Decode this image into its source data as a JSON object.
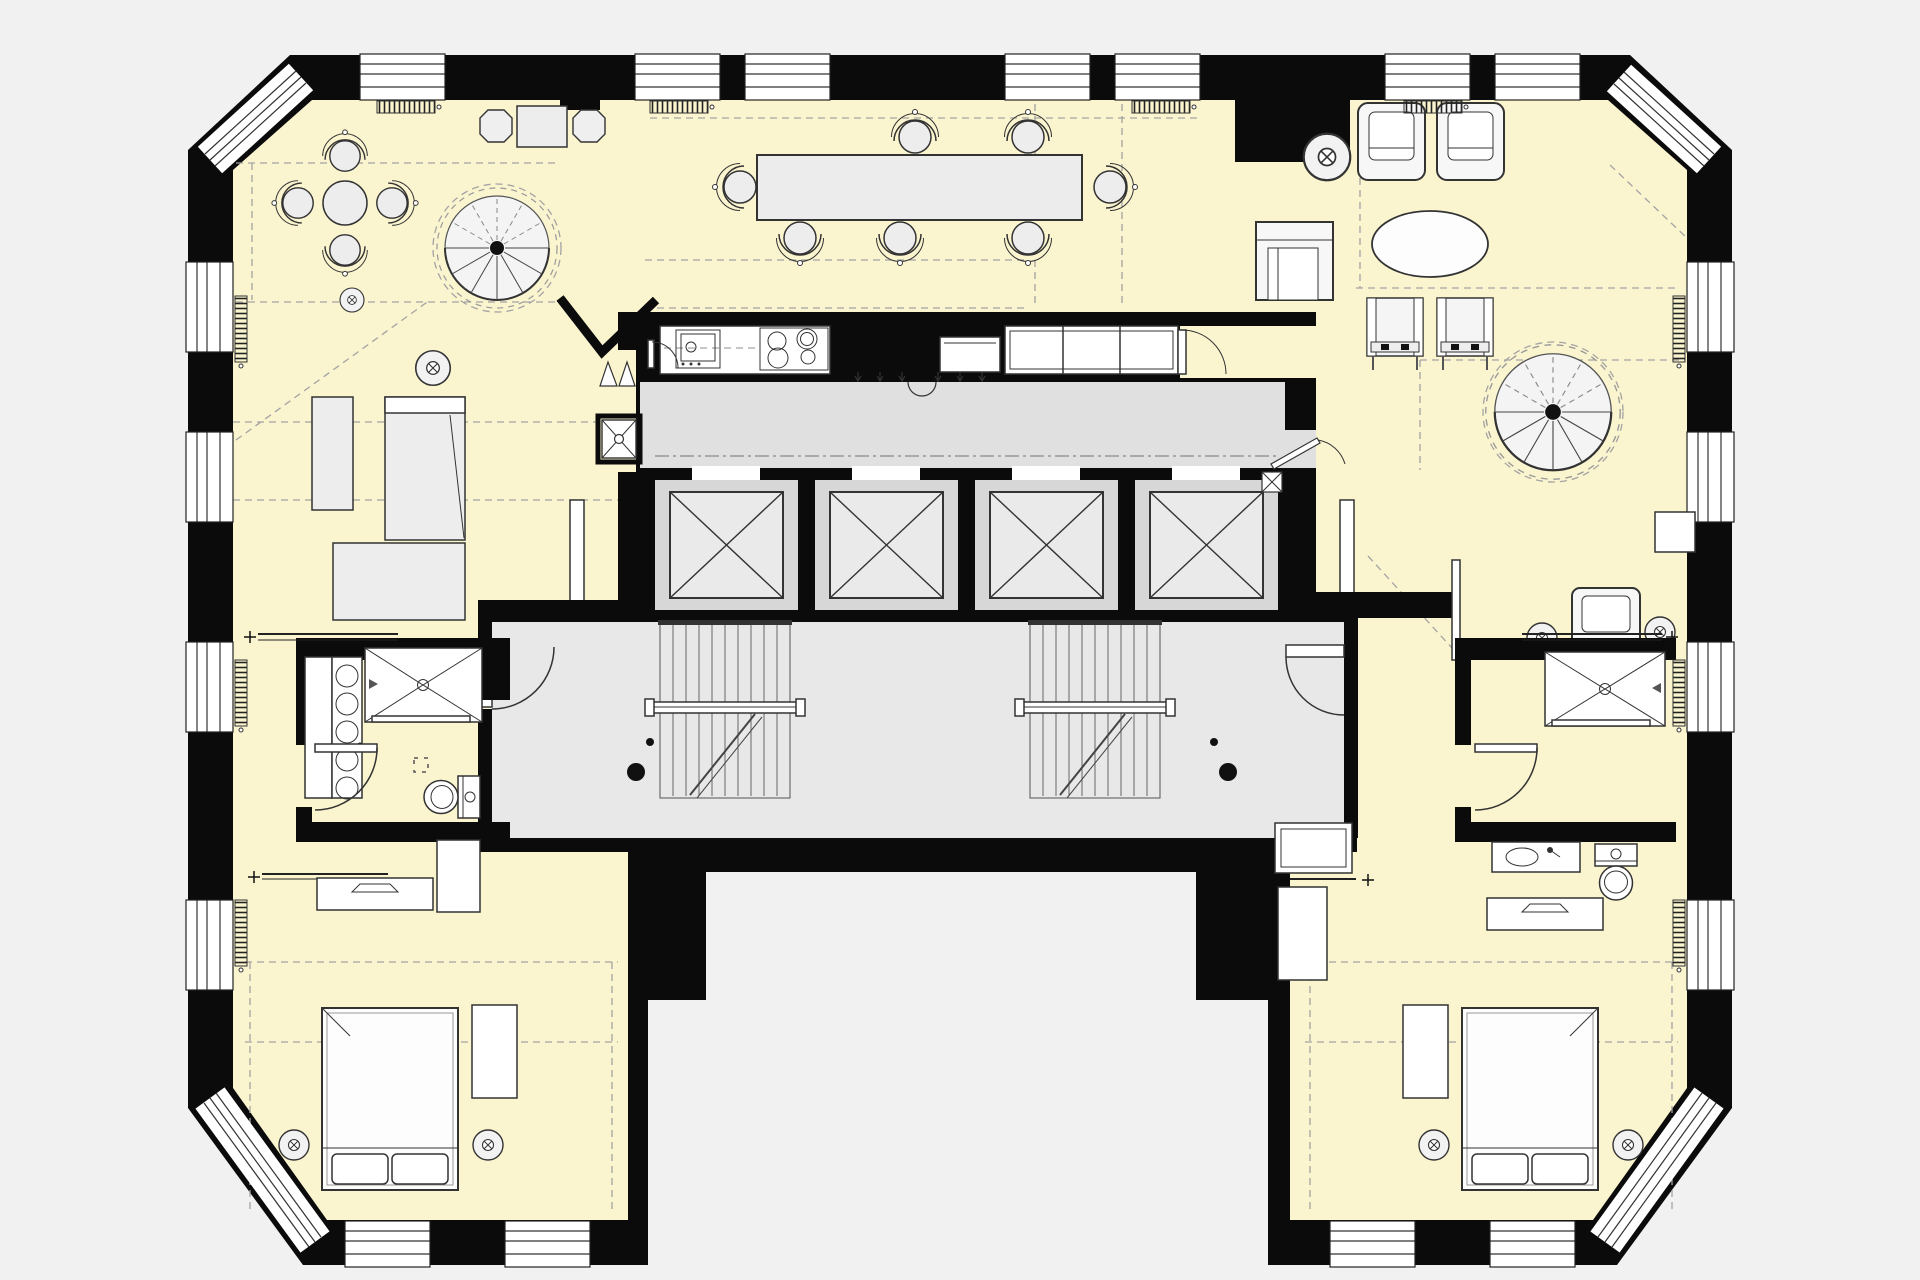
{
  "document_type": "architectural-floor-plan",
  "visible_text": [],
  "canvas": {
    "width": 1920,
    "height": 1280
  },
  "colors": {
    "bg": "#f1f1f2",
    "wall": "#0b0b0b",
    "room": "#faf4cf",
    "core": "#e0e0e0",
    "shaft-outer": "#d7d7d7",
    "shaft-inner": "#eaeaea",
    "stair": "#e8e8e8",
    "furn": "#ededed",
    "line": "#333333",
    "dash": "#a3a3a3"
  },
  "building": {
    "shape": "U-shaped tower floor with two lower wings and a full-width upper band",
    "corners": "four chamfered corners with window strips",
    "core": "central circulation core with elevator bank, two scissor stairs and corridors",
    "rooms_by_symbol": [
      "lounge-with-round-table",
      "dining-room",
      "living-room",
      "kitchen",
      "two-bathrooms",
      "two-bedrooms",
      "entry-halls"
    ]
  },
  "elements": {
    "windows_top": 7,
    "windows_bottom": 4,
    "windows_left": 4,
    "windows_right": 4,
    "chamfer_window_strips": 4,
    "elevator_shafts": 4,
    "stairwells": 2,
    "spiral_staircases": 2,
    "dining_table_chairs": 7,
    "round_table_chairs": 4,
    "octagonal_stools": 2,
    "lounge_armchairs": 2,
    "club_armchair": 1,
    "reading_chair": 1,
    "side_chairs": 2,
    "oval_coffee_table": 1,
    "cross_marked_round_tables": 8,
    "beds": 2,
    "showers": 2,
    "toilets": 2,
    "vanity": 1,
    "towel_radiator_circles": 5,
    "wall_radiators": 10,
    "kitchen_fixtures": [
      "sink",
      "cooktop-4-burner",
      "refrigerator",
      "cabinet-run"
    ],
    "door_swings": 8,
    "column_dots": 2
  }
}
